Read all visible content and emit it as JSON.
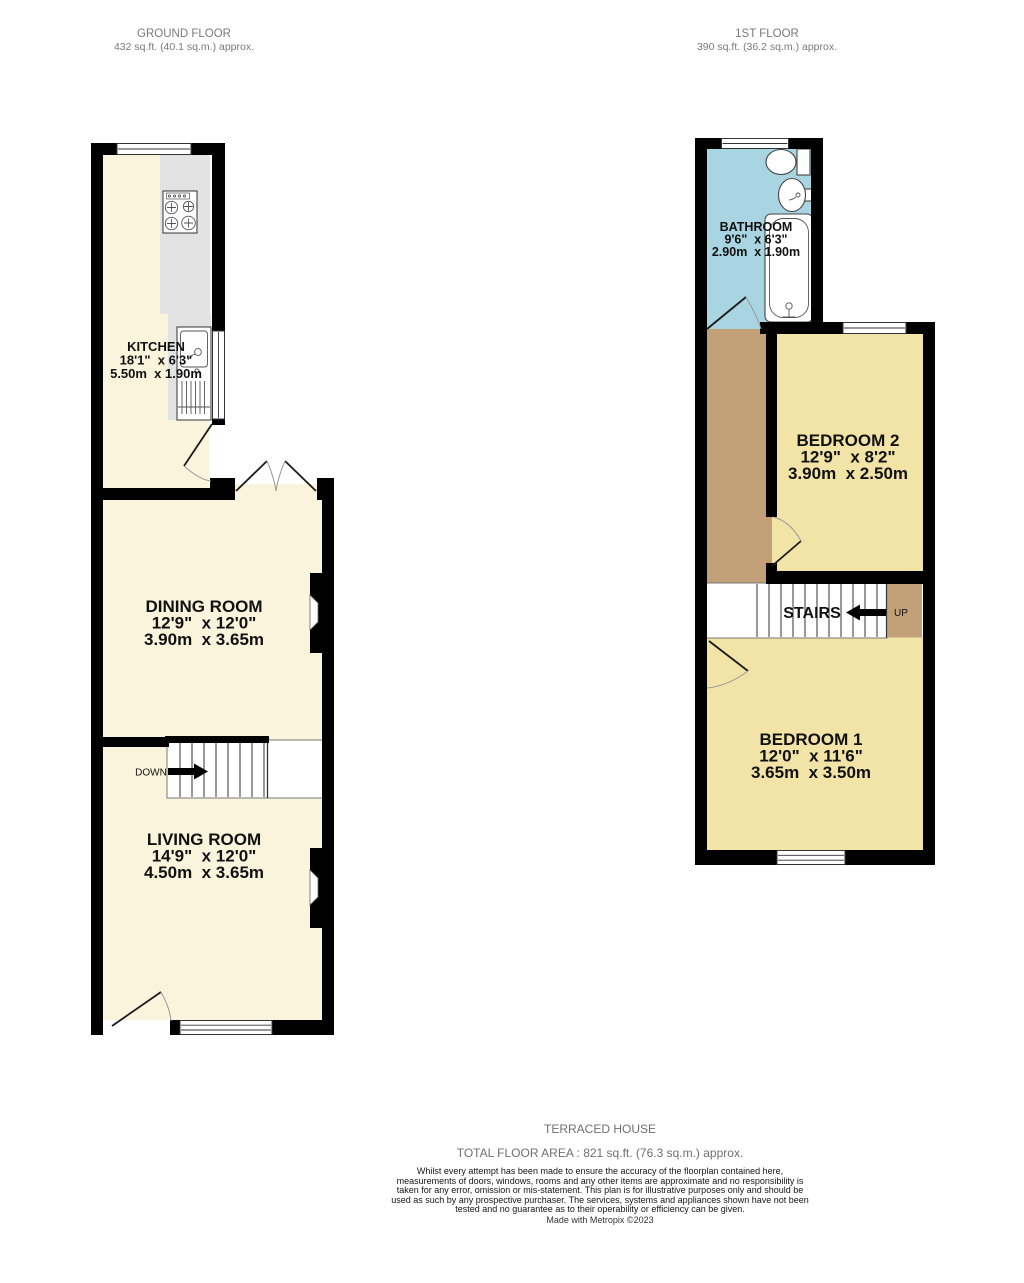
{
  "ground_floor": {
    "title": "GROUND FLOOR",
    "area": "432 sq.ft. (40.1 sq.m.) approx.",
    "stairs_label": "DOWN",
    "rooms": {
      "kitchen": {
        "name": "KITCHEN",
        "imperial": "18'1\"  x 6'3\"",
        "metric": "5.50m  x 1.90m"
      },
      "dining": {
        "name": "DINING ROOM",
        "imperial": "12'9\"  x 12'0\"",
        "metric": "3.90m  x 3.65m"
      },
      "living": {
        "name": "LIVING ROOM",
        "imperial": "14'9\"  x 12'0\"",
        "metric": "4.50m  x 3.65m"
      }
    }
  },
  "first_floor": {
    "title": "1ST FLOOR",
    "area": "390 sq.ft. (36.2 sq.m.) approx.",
    "stairs_label": "STAIRS",
    "up_label": "UP",
    "rooms": {
      "bathroom": {
        "name": "BATHROOM",
        "imperial": "9'6\"  x 6'3\"",
        "metric": "2.90m  x 1.90m"
      },
      "bedroom2": {
        "name": "BEDROOM 2",
        "imperial": "12'9\"  x 8'2\"",
        "metric": "3.90m  x 2.50m"
      },
      "bedroom1": {
        "name": "BEDROOM 1",
        "imperial": "12'0\"  x 11'6\"",
        "metric": "3.65m  x 3.50m"
      }
    }
  },
  "footer": {
    "property_type": "TERRACED HOUSE",
    "total_area": "TOTAL FLOOR AREA : 821 sq.ft. (76.3 sq.m.) approx.",
    "disclaimer": "Whilst every attempt has been made to ensure the accuracy of the floorplan contained here, measurements of doors, windows, rooms and any other items are approximate and no responsibility is taken for any error, omission or mis-statement. This plan is for illustrative purposes only and should be used as such by any prospective purchaser. The services, systems and appliances shown have not been tested and no guarantee as to their operability or efficiency can be given.",
    "credit": "Made with Metropix ©2023"
  },
  "colors": {
    "wall": "#000000",
    "room_cream": "#faf4dc",
    "room_yellow": "#f2e3a7",
    "bathroom_blue": "#a9d4e2",
    "landing_tan": "#c2a078",
    "counter_gray": "#e3e3e3"
  }
}
